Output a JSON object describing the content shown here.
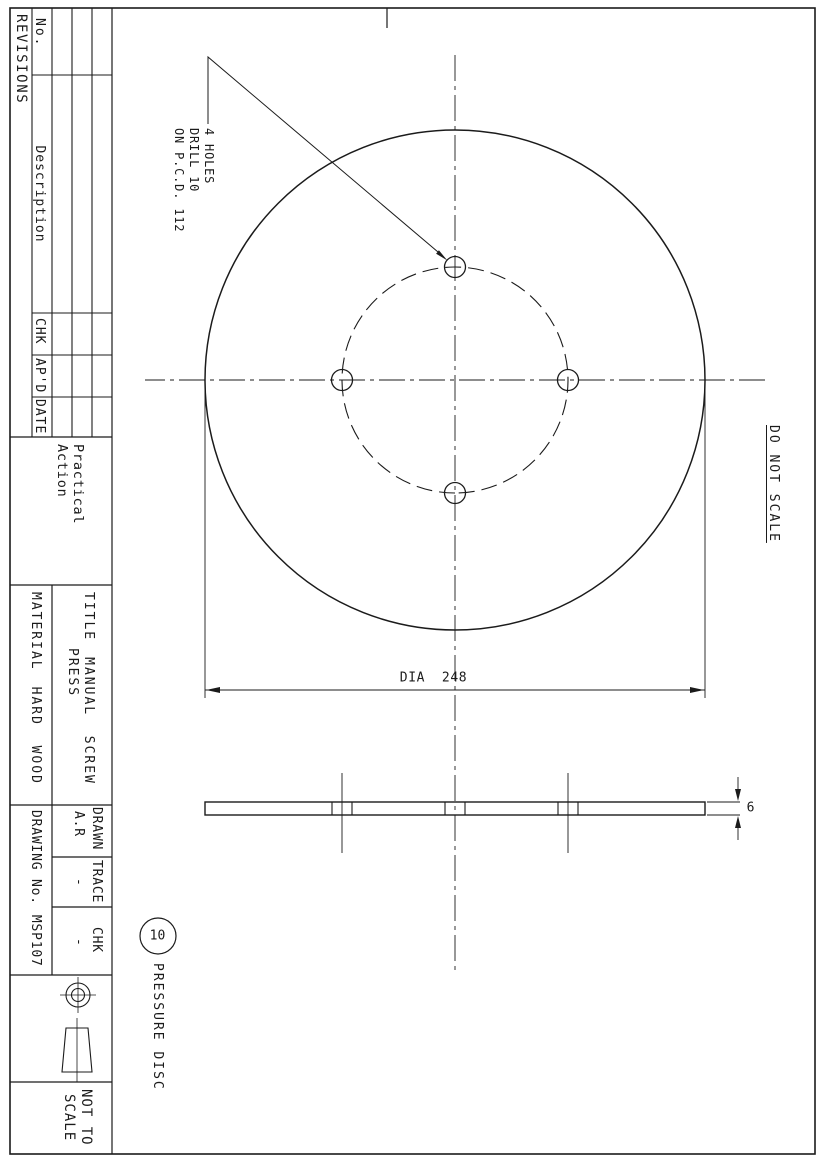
{
  "colors": {
    "paper": "#ffffff",
    "ink": "#1b1b1b"
  },
  "revisions": {
    "title": "REVISIONS",
    "col_no": "No.",
    "col_description": "Description",
    "col_chk": "CHK",
    "col_apd": "AP'D",
    "col_date": "DATE"
  },
  "logo": {
    "line1": "Practical",
    "line2": "Action"
  },
  "title_block": {
    "title_label": "TITLE",
    "title_line1": "MANUAL  SCREW",
    "title_line2": "PRESS",
    "material_label": "MATERIAL",
    "material_value": "HARD  WOOD",
    "drawn_label": "DRAWN",
    "drawn_value": "A.R",
    "trace_label": "TRACE",
    "trace_value": "-",
    "chk_label": "CHK",
    "chk_value": "-",
    "drawing_no_label": "DRAWING No.",
    "drawing_no_value": "MSP107",
    "scale_line1": "NOT TO",
    "scale_line2": "SCALE"
  },
  "annotations": {
    "hole_note_line1": "4 HOLES",
    "hole_note_line2": "DRILL 10",
    "hole_note_line3": "ON P.C.D. 112",
    "do_not_scale": "DO NOT SCALE",
    "dia_label": "DIA  248",
    "thickness_label": "6",
    "balloon": "10",
    "part_name": "PRESSURE DISC"
  },
  "part": {
    "outer_diameter": 248,
    "pitch_circle_diameter": 112,
    "hole_count": 4,
    "drill_diameter": 10,
    "thickness": 6,
    "material": "HARD WOOD",
    "drawing_number": "MSP107"
  }
}
